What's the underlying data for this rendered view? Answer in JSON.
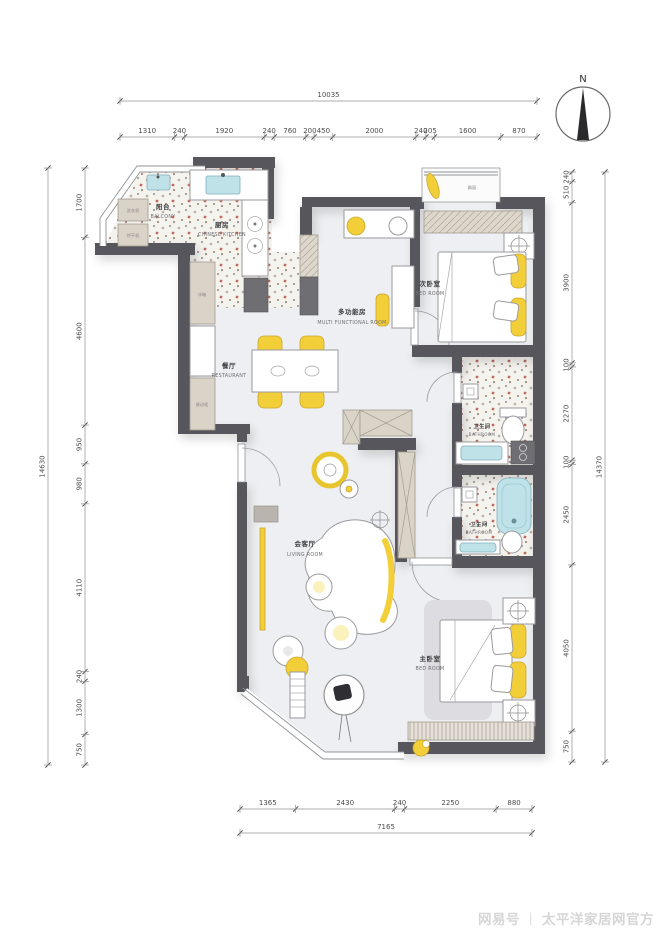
{
  "compass": {
    "label": "N"
  },
  "watermark": {
    "prefix": "网易号",
    "separator": "丨",
    "name": "太平洋家居网官方"
  },
  "dimensions": {
    "top": {
      "total": "10035",
      "segments": [
        "1310",
        "240",
        "1920",
        "240",
        "760",
        "200",
        "450",
        "2000",
        "240",
        "205",
        "1600",
        "870"
      ]
    },
    "bottom": {
      "total": "7165",
      "segments": [
        "1365",
        "2430",
        "240",
        "2250",
        "880"
      ]
    },
    "left": {
      "total": "14630",
      "segments": [
        "1700",
        "4600",
        "950",
        "980",
        "4110",
        "240",
        "1300",
        "750"
      ]
    },
    "right": {
      "total": "14370",
      "segments": [
        "240",
        "510",
        "3900",
        "100",
        "2270",
        "100",
        "2450",
        "4050",
        "750"
      ]
    }
  },
  "rooms": {
    "balcony": {
      "cn": "阳台",
      "en": "BALCONY"
    },
    "kitchen": {
      "cn": "厨房",
      "en": "CHINESE KITCHEN"
    },
    "multi_room": {
      "cn": "多功能房",
      "en": "MULTI FUNCTIONAL ROOM"
    },
    "second_bedroom": {
      "cn": "次卧室",
      "en": "BED ROOM"
    },
    "restaurant": {
      "cn": "餐厅",
      "en": "RESTAURANT"
    },
    "bathroom_1": {
      "cn": "卫生间",
      "en": "BATHROOM"
    },
    "bathroom_2": {
      "cn": "卫生间",
      "en": "BATHROOM"
    },
    "living_room": {
      "cn": "会客厅",
      "en": "LIVING ROOM"
    },
    "master_bedroom": {
      "cn": "主卧室",
      "en": "BED ROOM"
    }
  },
  "labels": {
    "washer": "洗衣机",
    "dryer": "烘干机",
    "fridge": "冰箱",
    "sideboard": "餐边柜",
    "bay_window": "飘窗"
  },
  "colors": {
    "wall": "#57575c",
    "accent": "#f2cf39",
    "water": "#bfe2e9",
    "cabinet": "#d9d3c8",
    "floor": "#edeff2"
  }
}
